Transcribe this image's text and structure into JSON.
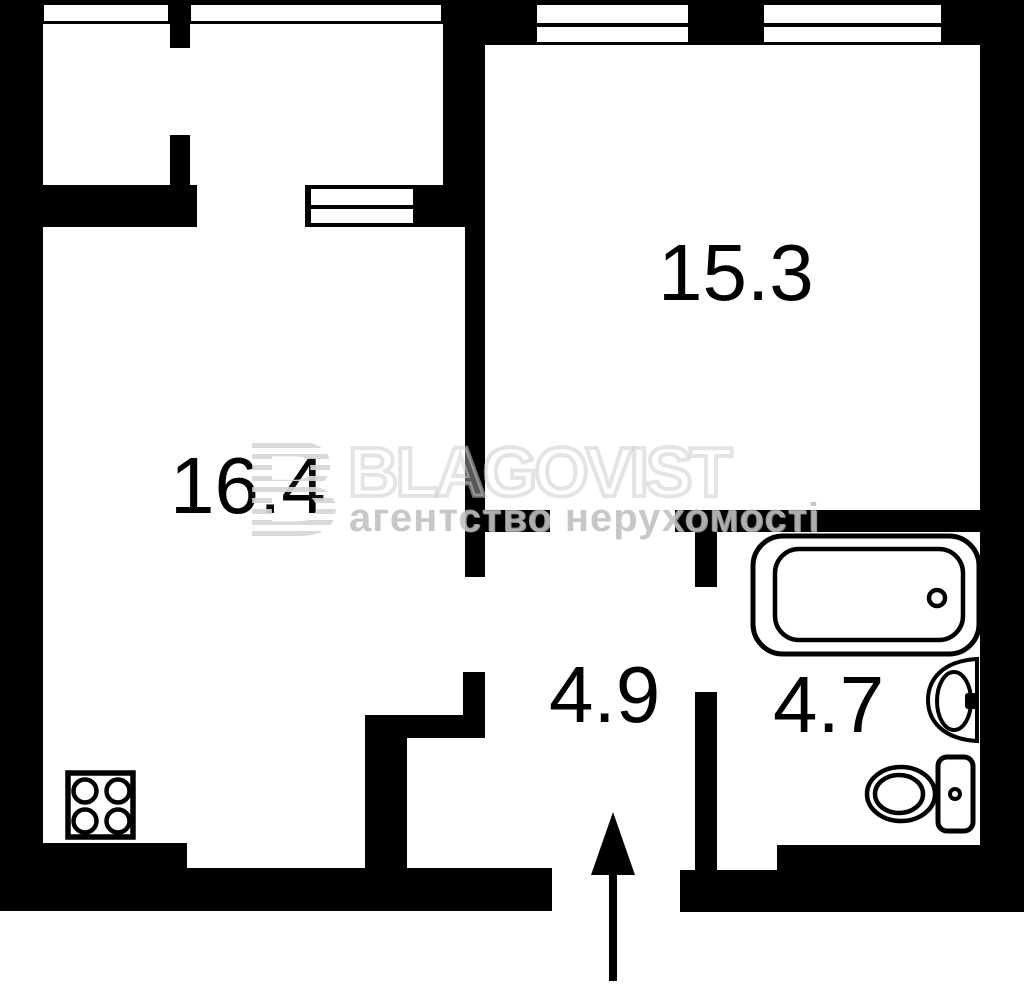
{
  "plan": {
    "background_color": "#ffffff",
    "wall_color": "#000000",
    "label_color": "#000000",
    "rooms": [
      {
        "name": "living-room",
        "area_label": "16.4"
      },
      {
        "name": "bedroom",
        "area_label": "15.3"
      },
      {
        "name": "hallway",
        "area_label": "4.9"
      },
      {
        "name": "bathroom",
        "area_label": "4.7"
      }
    ],
    "fixtures": [
      "bathtub-icon",
      "washbasin-icon",
      "toilet-icon",
      "stove-icon",
      "entrance-arrow-icon",
      "window-icon"
    ]
  },
  "watermark": {
    "logo_letter": "B",
    "brand": "BLAGOVIST",
    "subtitle": "агентство нерухомості",
    "brand_color": "#d6d6d6",
    "subtitle_color": "#b7b7b7"
  }
}
